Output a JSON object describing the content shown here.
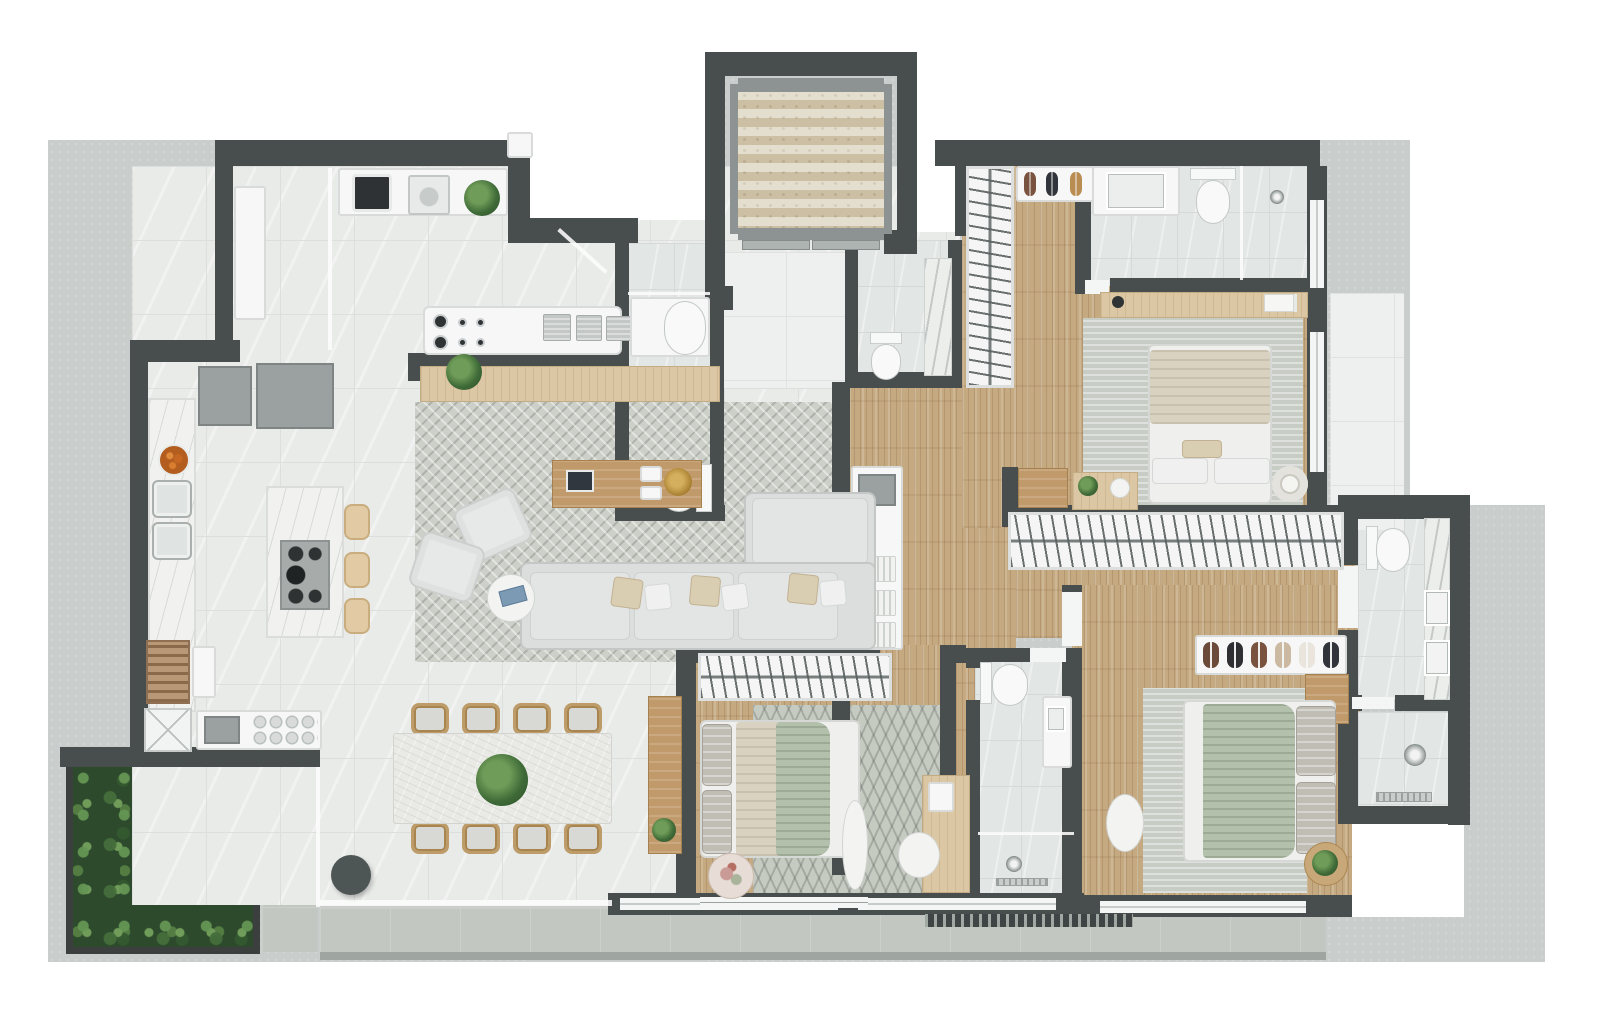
{
  "scene": {
    "type": "3d-rendered-floor-plan",
    "description": "Top-down 3D render of a three-bedroom apartment with open living/dining/kitchen, elevator core, three suites, service area, terrace with vertical garden",
    "rooms": [
      "pantry",
      "laundry",
      "kitchen",
      "living-room",
      "dining-area",
      "foyer",
      "elevator",
      "powder-room",
      "service-bathroom",
      "bedroom-1-suite",
      "bathroom-1",
      "walk-in-closet",
      "hallway",
      "master-bedroom",
      "master-bathroom",
      "master-shower",
      "bedroom-3",
      "bathroom-3",
      "terrace",
      "vertical-garden",
      "balcony"
    ],
    "counts": {
      "bedrooms": 3,
      "bathrooms": 5,
      "dining_chairs": 8,
      "bar_stools": 3,
      "sofa_pillows": 6,
      "shoe_pairs_rack": 6
    }
  },
  "palette": {
    "background": "#ffffff",
    "slab": "#c9cdcb",
    "wall": "#484d4d",
    "interior_tile": "#e9ebe9",
    "bath_tile": "#e2e6e5",
    "wood_floor": "#c5a981",
    "rug": "#ccd0c8",
    "terrace": "#c2c8c1",
    "garden_green": "#2d4a2c",
    "travertine": "#d9d0ba",
    "furniture_white": "#f6f7f6",
    "wood_furniture": "#c19a6b",
    "sofa_gray": "#dcdedd",
    "blanket_green": "#b3c0ab",
    "blanket_beige": "#d9d2c0",
    "stool_beige": "#e2cba4",
    "gold_accent": "#a87e30",
    "fruit_orange": "#c56722"
  }
}
